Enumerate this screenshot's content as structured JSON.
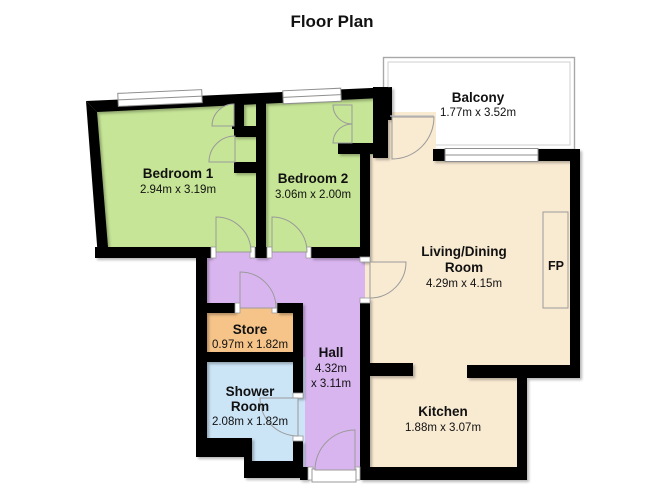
{
  "title": "Floor Plan",
  "rooms": {
    "bedroom1": {
      "name": "Bedroom 1",
      "dims": "2.94m x 3.19m"
    },
    "bedroom2": {
      "name": "Bedroom 2",
      "dims": "3.06m x 2.00m"
    },
    "balcony": {
      "name": "Balcony",
      "dims": "1.77m x 3.52m"
    },
    "living": {
      "name_line1": "Living/Dining",
      "name_line2": "Room",
      "dims": "4.29m x 4.15m"
    },
    "store": {
      "name": "Store",
      "dims": "0.97m x 1.82m"
    },
    "hall": {
      "name": "Hall",
      "dims_line1": "4.32m",
      "dims_line2": "x 3.11m"
    },
    "shower": {
      "name_line1": "Shower",
      "name_line2": "Room",
      "dims": "2.08m x 1.82m"
    },
    "kitchen": {
      "name": "Kitchen",
      "dims": "1.88m x 3.07m"
    }
  },
  "labels": {
    "fireplace": "FP"
  },
  "colors": {
    "bedroom_green": "#c6e596",
    "living_cream": "#f9ead2",
    "hall_purple": "#d9b5f0",
    "store_orange": "#f6c489",
    "shower_blue": "#cbe4f6",
    "wall_black": "#050505",
    "balcony_white": "#ffffff",
    "railing_gray": "#a8a8a8"
  }
}
